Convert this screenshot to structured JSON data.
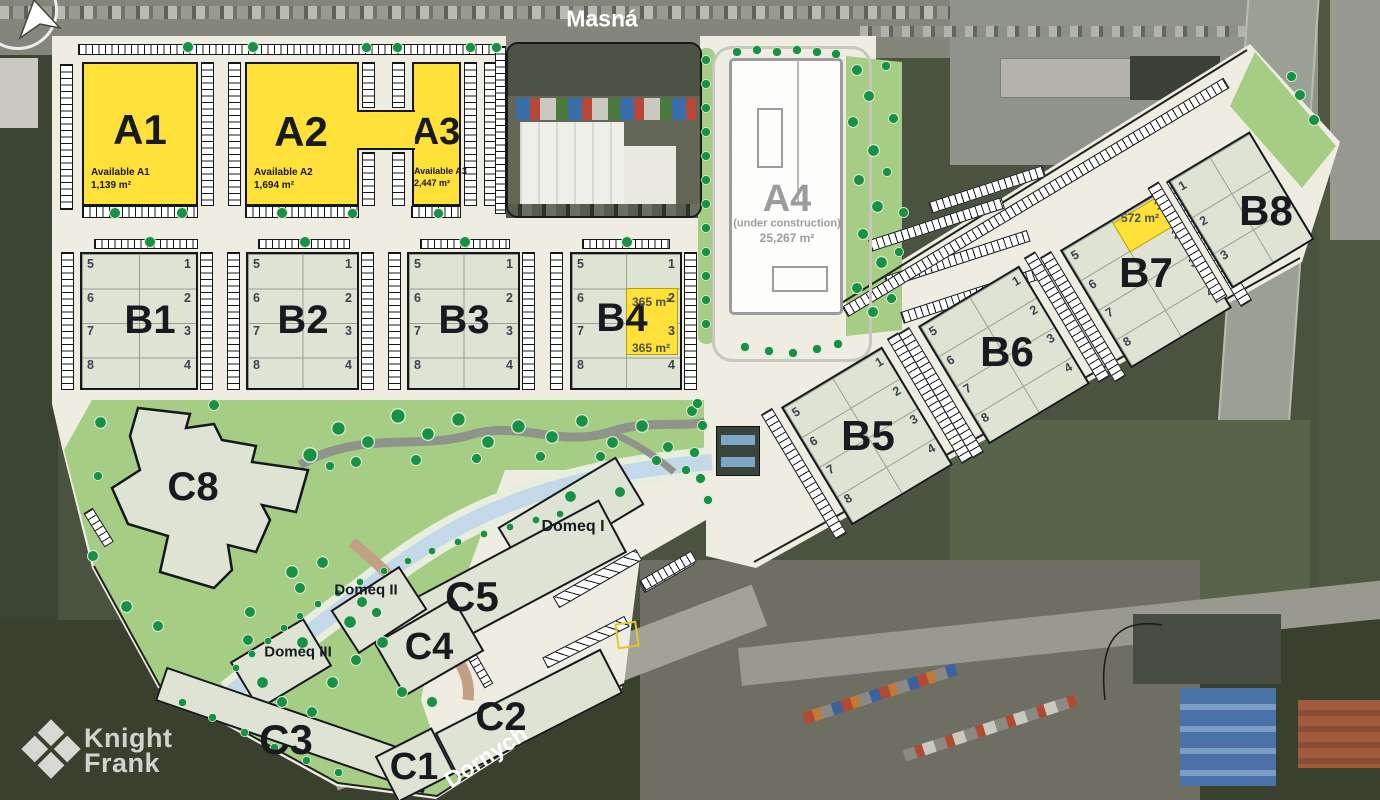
{
  "streets": {
    "top": "Masná",
    "bottom": "Dornych"
  },
  "logo": {
    "line1": "Knight",
    "line2": "Frank"
  },
  "buildings": {
    "a1": {
      "label": "A1",
      "available_label": "Available A1",
      "area": "1,139 m²"
    },
    "a2": {
      "label": "A2",
      "available_label": "Available A2",
      "area": "1,694 m²"
    },
    "a3": {
      "label": "A3",
      "available_label": "Available A3",
      "area": "2,447 m²"
    },
    "a4": {
      "label": "A4",
      "status": "(under construction)",
      "area": "25,267 m²"
    },
    "b1": {
      "label": "B1"
    },
    "b2": {
      "label": "B2"
    },
    "b3": {
      "label": "B3"
    },
    "b4": {
      "label": "B4",
      "unit_highlights": [
        {
          "unit": "2",
          "area": "365 m²"
        },
        {
          "unit": "3",
          "area": "365 m²"
        }
      ]
    },
    "b5": {
      "label": "B5"
    },
    "b6": {
      "label": "B6"
    },
    "b7": {
      "label": "B7",
      "unit_highlights": [
        {
          "unit": "1",
          "area": "572 m²"
        }
      ]
    },
    "b8": {
      "label": "B8"
    },
    "c1": {
      "label": "C1"
    },
    "c2": {
      "label": "C2"
    },
    "c3": {
      "label": "C3"
    },
    "c4": {
      "label": "C4"
    },
    "c5": {
      "label": "C5"
    },
    "c8": {
      "label": "C8"
    },
    "domeq1": {
      "label": "Domeq I"
    },
    "domeq2": {
      "label": "Domeq II"
    },
    "domeq3": {
      "label": "Domeq III"
    }
  },
  "unit_numbers": {
    "left": [
      "5",
      "6",
      "7",
      "8"
    ],
    "right": [
      "1",
      "2",
      "3",
      "4"
    ],
    "b8": [
      "1",
      "2",
      "3"
    ]
  },
  "colors": {
    "available_yellow": "#ffe13a",
    "building_sage": "#dfe3d4",
    "plan_cream": "#efece1",
    "landscape_green": "#a6cd84",
    "tree_green": "#179146",
    "river_blue": "#c3d9e9",
    "under_construction_gray": "#9c9c9c"
  }
}
